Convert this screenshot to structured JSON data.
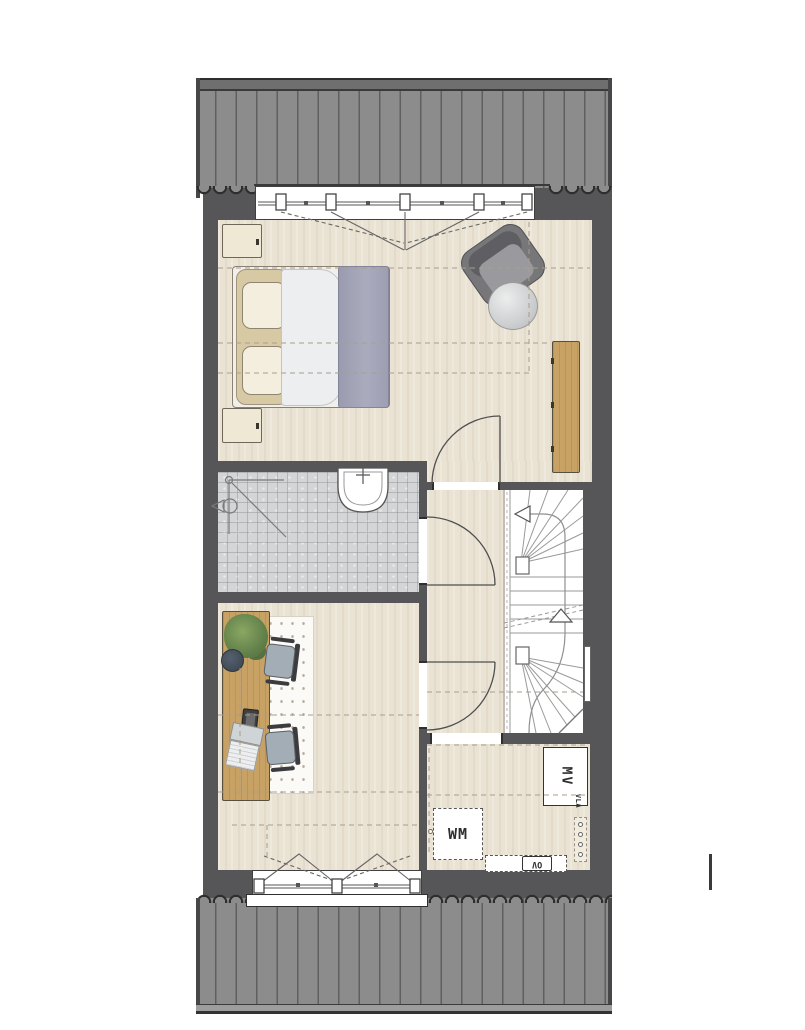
{
  "plan": {
    "labels": {
      "washing_machine": "WM",
      "mechanical_ventilation": "MV",
      "heater": "OV",
      "loft_hatch": "VLA"
    },
    "colors": {
      "roof": "#8c8c8c",
      "roof_line": "#5f5f5f",
      "wall": "#565658",
      "floor": "#eae3d4",
      "bathroom_floor": "#d3d5d7",
      "wood": "#c8a264",
      "blanket": "#a2a2b6",
      "armchair": "#77777a",
      "rug": "#fbfaf7",
      "plant": "#6d8a4f",
      "line": "#4a4a4a"
    }
  }
}
